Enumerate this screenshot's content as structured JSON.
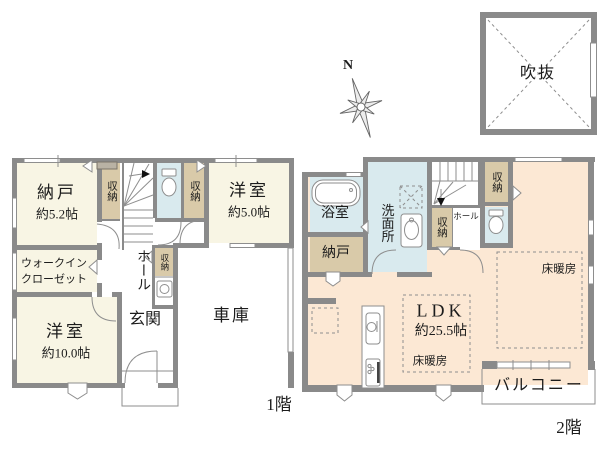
{
  "colors": {
    "wall": "#8a8a8a",
    "line": "#8e8e8e",
    "cream": "#f8f5e4",
    "beige": "#d9caa9",
    "blue": "#d9eaee",
    "peach": "#fce8d4"
  },
  "compass": {
    "north_label": "N"
  },
  "atrium": {
    "label": "吹抜"
  },
  "floor1": {
    "label": "1階",
    "nando": {
      "name": "納戸",
      "size": "約5.2帖"
    },
    "storage_a": {
      "name": "収納"
    },
    "storage_b": {
      "name": "収納"
    },
    "storage_c": {
      "name": "収納"
    },
    "yoshitsu_5": {
      "name": "洋室",
      "size": "約5.0帖"
    },
    "wic": {
      "line1": "ウォークイン",
      "line2": "クローゼット"
    },
    "hall": {
      "name": "ホール"
    },
    "genkan": {
      "name": "玄関"
    },
    "yoshitsu_10": {
      "name": "洋室",
      "size": "約10.0帖"
    },
    "garage": {
      "name": "車庫"
    }
  },
  "floor2": {
    "label": "2階",
    "bathroom": {
      "name": "浴室"
    },
    "washroom": {
      "name": "洗面所"
    },
    "nando": {
      "name": "納戸"
    },
    "storage_left": {
      "name": "収納"
    },
    "storage_top": {
      "name": "収納"
    },
    "hall": {
      "name": "ホール"
    },
    "ldk": {
      "name": "LDK",
      "size": "約25.5帖"
    },
    "floor_heating_center": {
      "name": "床暖房"
    },
    "floor_heating_right": {
      "name": "床暖房"
    },
    "balcony": {
      "name": "バルコニー"
    }
  }
}
